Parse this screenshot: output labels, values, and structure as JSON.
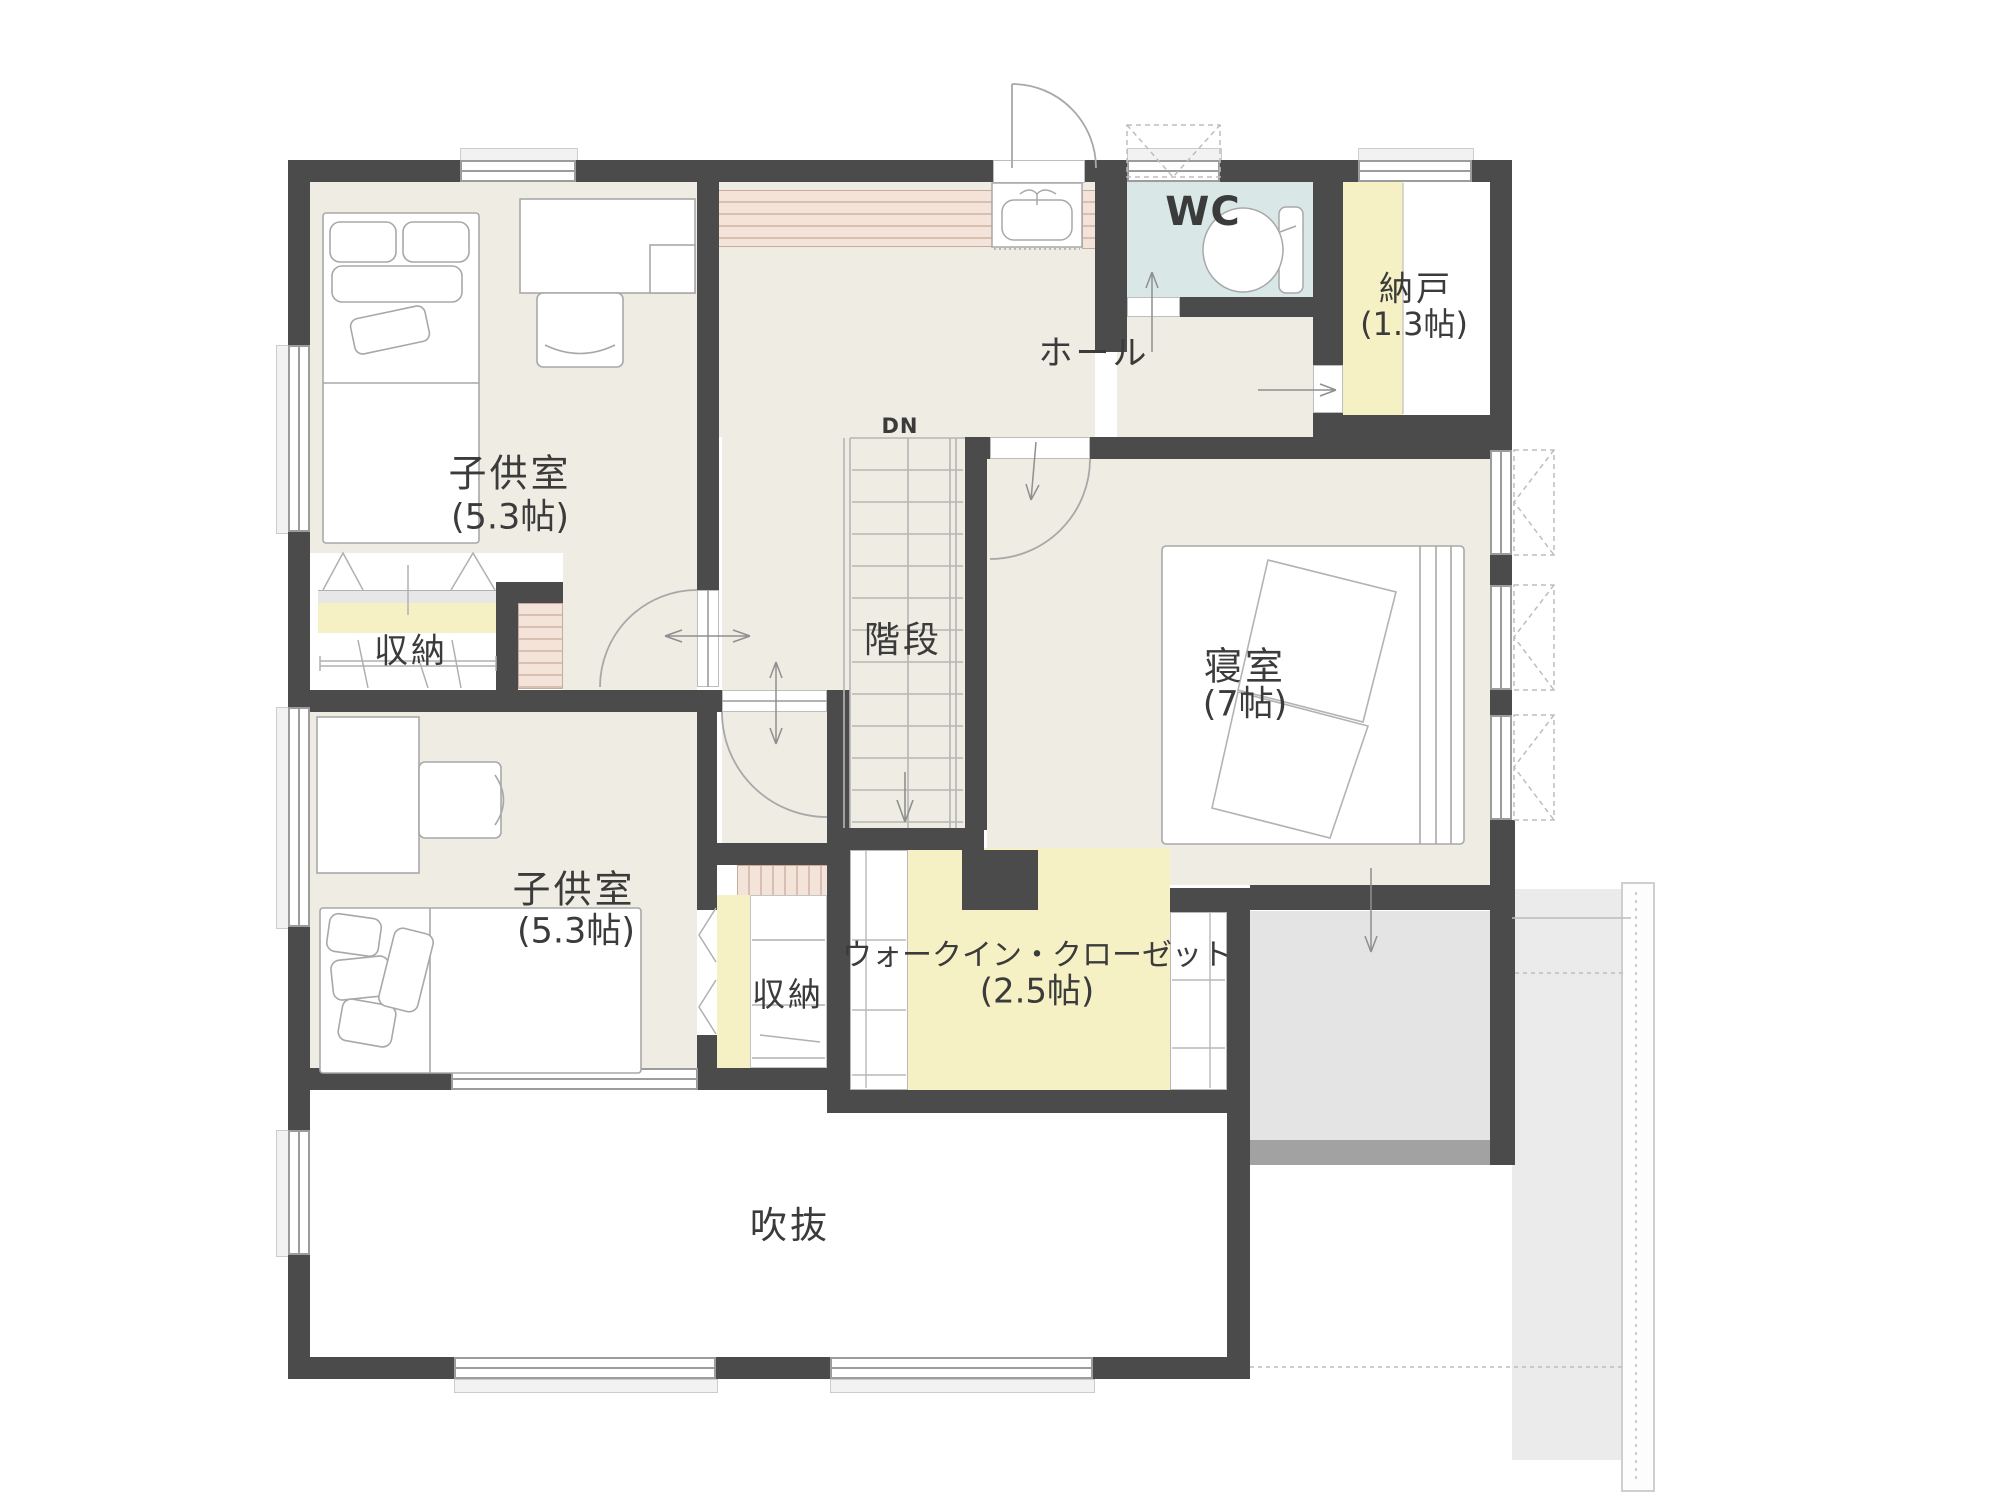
{
  "plan": {
    "type": "floor-plan",
    "floor_note": "2F",
    "rooms": {
      "kids_room_1": {
        "name": "子供室",
        "size": "(5.3帖)"
      },
      "kids_room_2": {
        "name": "子供室",
        "size": "(5.3帖)"
      },
      "bedroom": {
        "name": "寝室",
        "size": "(7帖)"
      },
      "walk_in_closet": {
        "name": "ウォークイン・クローゼット",
        "size": "(2.5帖)"
      },
      "nando": {
        "name": "納戸",
        "size": "(1.3帖)"
      },
      "wc": {
        "name": "WC"
      },
      "hall": {
        "name": "ホール"
      },
      "stairs": {
        "name": "階段",
        "marker": "DN"
      },
      "storage_1": {
        "name": "収納"
      },
      "storage_2": {
        "name": "収納"
      },
      "void": {
        "name": "吹抜"
      }
    },
    "colors": {
      "wall": "#4b4b4b",
      "floor_beige": "#efece3",
      "wc_floor_blue": "#d9e8e7",
      "storage_yellow": "#f6f0c5",
      "counter_pink": "#f4e3d9",
      "roof_grey": "#e4e4e4",
      "roof_dark_grey": "#a2a2a2",
      "linework": "#a0a0a0",
      "text": "#3b3b3b"
    }
  }
}
